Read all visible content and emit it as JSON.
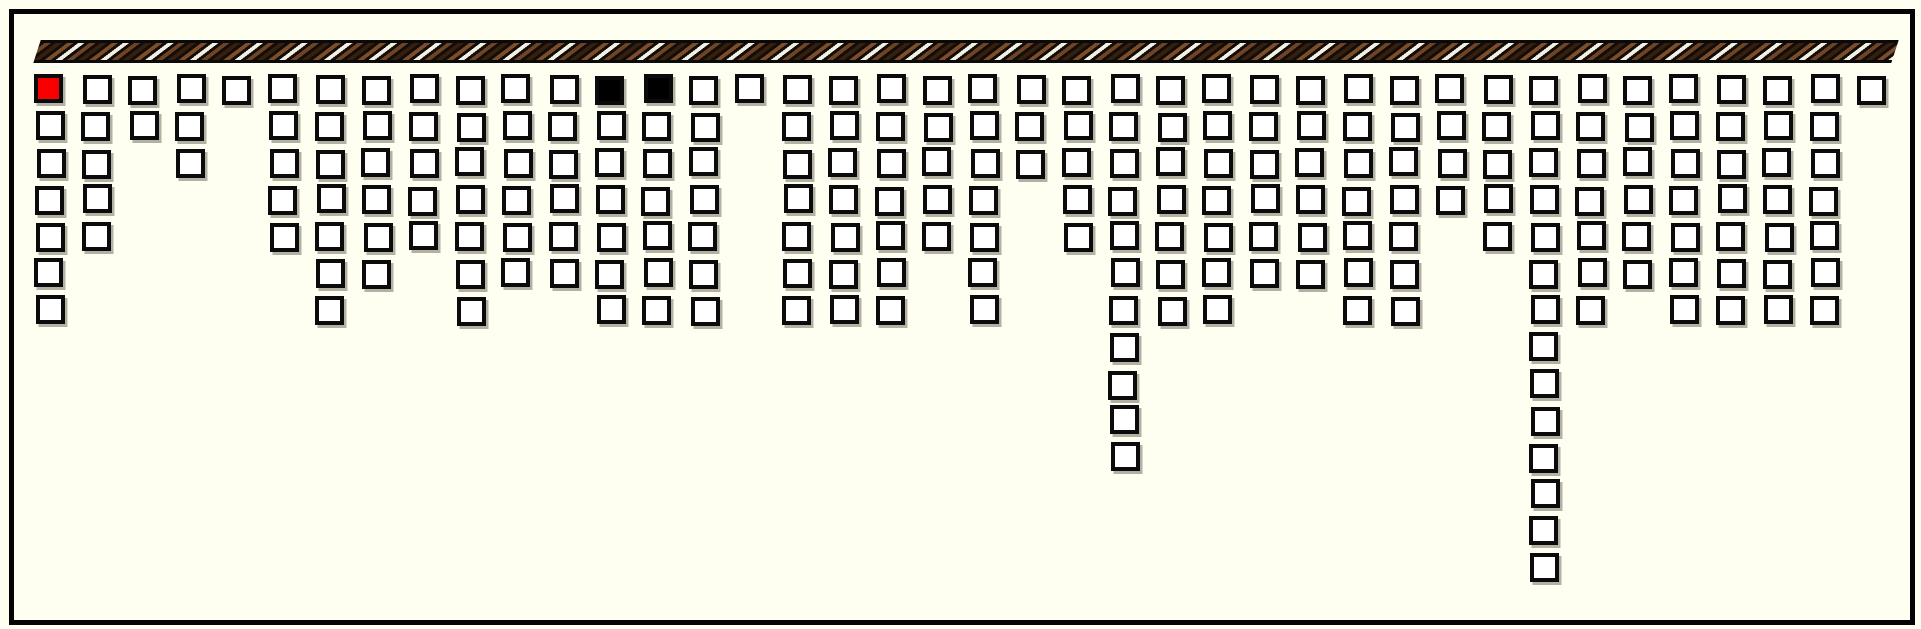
{
  "canvas": {
    "width": 1921,
    "height": 629,
    "background": "#FFFFF1"
  },
  "frame": {
    "left": 9,
    "top": 9,
    "width": 1906,
    "height": 616,
    "border_px": 5,
    "border_color": "#040404"
  },
  "rope": {
    "left": 37,
    "top": 40,
    "width": 1858,
    "height": 23,
    "skew_deg": -18,
    "stripe_angle_deg": 135,
    "stripe_colors": {
      "dark_gap": "#140c06",
      "brown_mid": "#6e4426",
      "brown_dark": "#35200f",
      "brown_light": "#7b4d2b",
      "white": "#f2efe4"
    },
    "stripe_widths_px": {
      "dark_gap": 3.5,
      "color_stripe": 4.4
    }
  },
  "grid": {
    "origin_left": 35.5,
    "origin_top": 75,
    "pitch_x": 46.7,
    "pitch_y": 36.8,
    "square_outer_px": 29,
    "square_border_px": 4.5,
    "square_border_color": "#0b0b0b",
    "square_fill_default": "#ffffff",
    "shadow_color": "rgba(75,70,58,0.42)",
    "shadow_offset_x": 2.5,
    "shadow_offset_y": 3
  },
  "chart_data": {
    "type": "bar",
    "subtype": "hanging-unit-chart: columns of outlined squares suspended from a striped rope; each column is a contiguous stack growing downward from the rope",
    "title": "",
    "xlabel": "",
    "ylabel": "",
    "legend": null,
    "grid_lines": "off",
    "num_columns": 40,
    "categories": [
      1,
      2,
      3,
      4,
      5,
      6,
      7,
      8,
      9,
      10,
      11,
      12,
      13,
      14,
      15,
      16,
      17,
      18,
      19,
      20,
      21,
      22,
      23,
      24,
      25,
      26,
      27,
      28,
      29,
      30,
      31,
      32,
      33,
      34,
      35,
      36,
      37,
      38,
      39,
      40
    ],
    "values": [
      7,
      5,
      2,
      3,
      1,
      5,
      7,
      6,
      5,
      7,
      6,
      6,
      7,
      7,
      7,
      1,
      7,
      7,
      7,
      5,
      7,
      3,
      5,
      11,
      7,
      7,
      6,
      6,
      7,
      7,
      4,
      5,
      14,
      7,
      6,
      7,
      7,
      7,
      7,
      1
    ],
    "value_range": [
      1,
      14
    ],
    "total_squares": 239,
    "special_squares": [
      {
        "column": 1,
        "row": 1,
        "color": "#F80000",
        "name": "red-square"
      },
      {
        "column": 13,
        "row": 1,
        "color": "#000000",
        "name": "black-square"
      },
      {
        "column": 14,
        "row": 1,
        "color": "#000000",
        "name": "black-square"
      }
    ],
    "default_square_color": "#ffffff"
  }
}
